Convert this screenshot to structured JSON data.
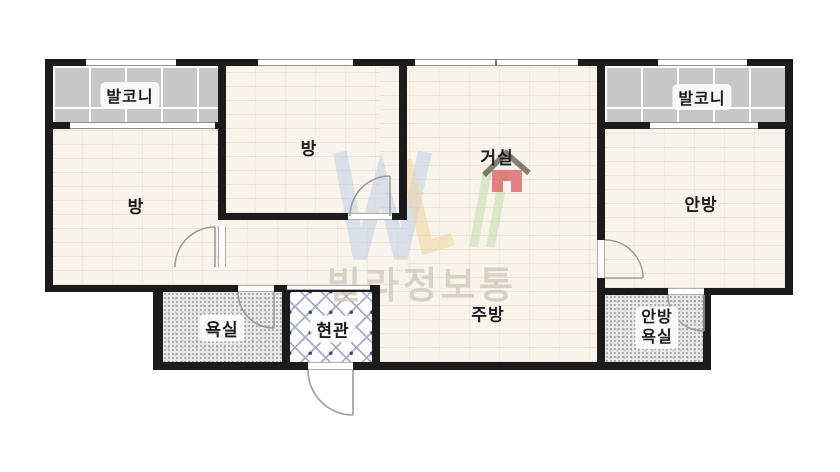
{
  "floorplan": {
    "rooms": {
      "balcony_left": "발코니",
      "room_left": "방",
      "room_middle": "방",
      "living": "거실",
      "balcony_right": "발코니",
      "master": "안방",
      "bath": "욕실",
      "entry": "현관",
      "kitchen": "주방",
      "master_bath_line1": "안방",
      "master_bath_line2": "욕실"
    },
    "watermark": {
      "text": "빌라정보통"
    },
    "colors": {
      "wall": "#1b1b1b",
      "floor": "#f8f4ec",
      "balcony": "#c7c7c7",
      "bath": "#e9e9e9",
      "door": "#9c9c9c",
      "label": "#1c1c1c",
      "wm-text": "#d2c9bc",
      "logo-blue": "#b9c9e6",
      "logo-yellow": "#f0d6a4",
      "logo-green": "#c9ddb4",
      "logo-red": "#db5c5c"
    }
  }
}
